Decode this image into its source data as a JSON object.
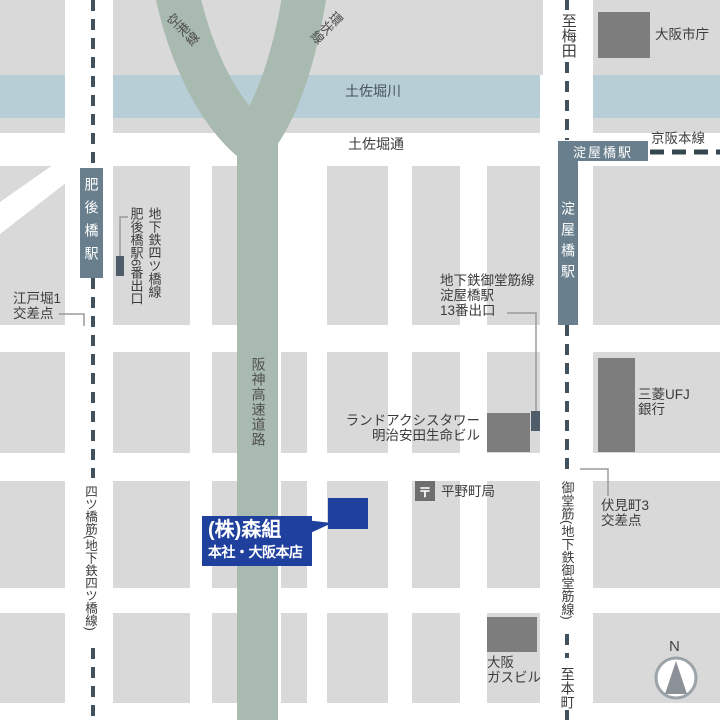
{
  "map_title": "(株)森組 本社・大阪本店 周辺地図",
  "colors": {
    "block_gray": "#d9d9d9",
    "building_gray": "#7d7d7d",
    "river_blue": "#b8ced6",
    "highway_green": "#a9bab0",
    "station_slate": "#697f8d",
    "subway_dash": "#41525e",
    "destination_navy": "#20409e"
  },
  "river": {
    "label": "土佐堀川"
  },
  "roads": {
    "tosabori_dori": "土佐堀通",
    "hanshin_expressway": "阪神高速道路",
    "branch_left": "空港線",
    "branch_right": "環状線",
    "yotsubashi_suji": "四ツ橋筋(地下鉄四ツ橋線)",
    "midosuji": "御堂筋(地下鉄御堂筋線)",
    "keihan_line": "京阪本線",
    "to_umeda": "至梅田",
    "to_hommachi": "至本町"
  },
  "stations": {
    "higobashi": "肥後橋駅",
    "yodoyabashi_keihan": "淀屋橋駅",
    "yodoyabashi_subway": "淀屋橋駅"
  },
  "exits": {
    "higobashi_line": "地下鉄四ツ橋線",
    "higobashi_exit": "肥後橋駅6番出口",
    "yodoyabashi_line1": "地下鉄御堂筋線",
    "yodoyabashi_line2": "淀屋橋駅",
    "yodoyabashi_line3": "13番出口"
  },
  "intersections": {
    "edobori_line1": "江戸堀1",
    "edobori_line2": "交差点",
    "fushimicho_line1": "伏見町3",
    "fushimicho_line2": "交差点"
  },
  "buildings": {
    "city_hall": "大阪市庁",
    "mufg_line1": "三菱UFJ",
    "mufg_line2": "銀行",
    "landaxis_line1": "ランドアクシスタワー",
    "landaxis_line2": "明治安田生命ビル",
    "gas_line1": "大阪",
    "gas_line2": "ガスビル",
    "post_office": "平野町局",
    "post_mark": "〒"
  },
  "destination": {
    "name": "(株)森組",
    "sub": "本社・大阪本店"
  },
  "compass": {
    "label": "N"
  }
}
